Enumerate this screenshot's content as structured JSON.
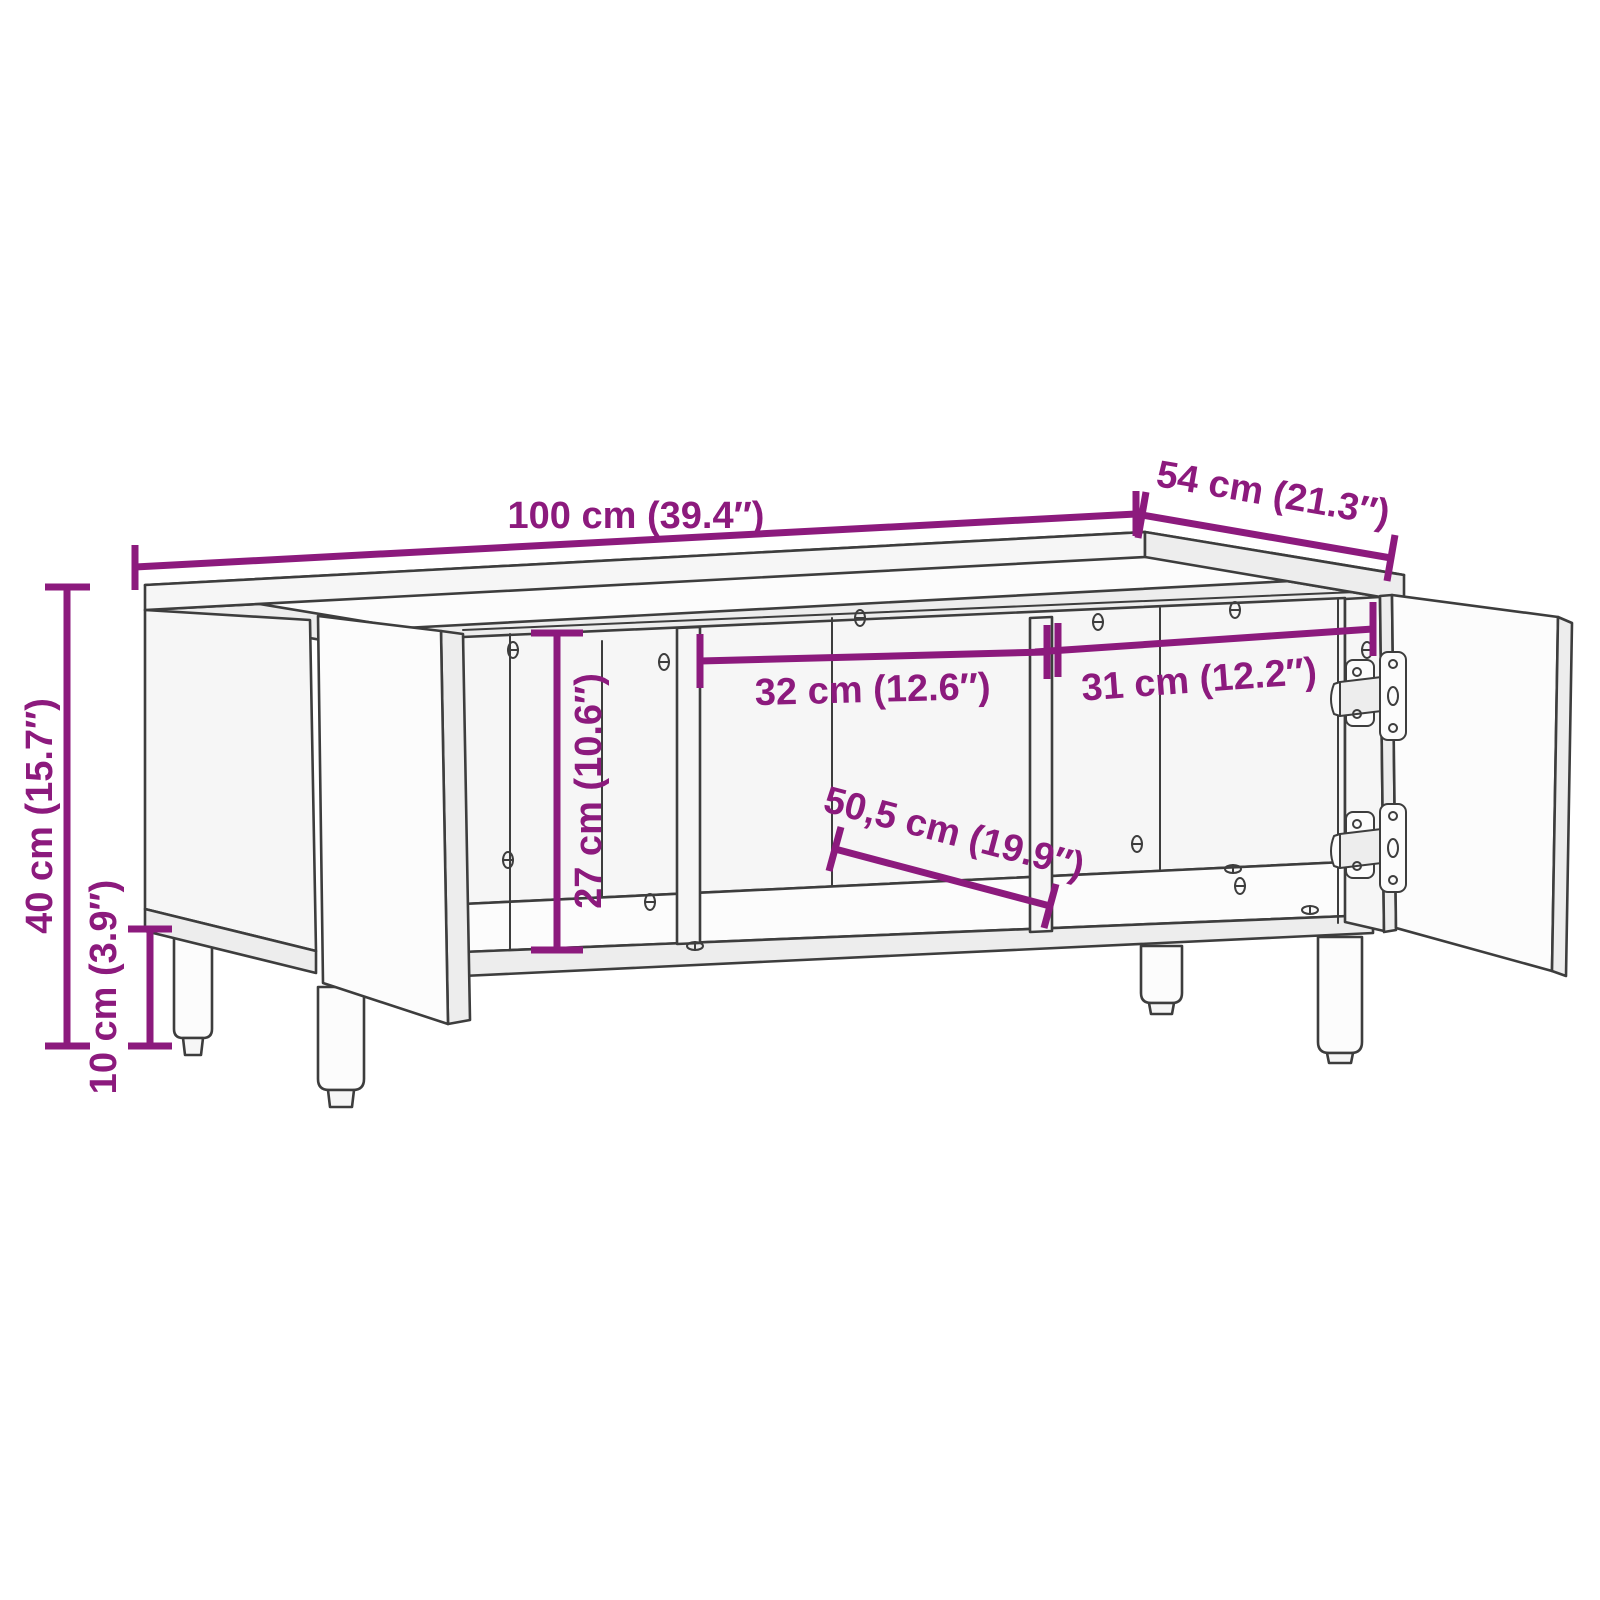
{
  "diagram": {
    "kind": "furniture-dimension-diagram",
    "subject": "cabinet with two open doors, three open compartments and four round legs",
    "colors": {
      "accent": "#8C1A7D",
      "line_art": "#3D3D3D",
      "background": "#FFFFFF"
    },
    "dimensions": {
      "width": {
        "cm": 100,
        "inches": 39.4,
        "label": "100 cm (39.4″)"
      },
      "depth": {
        "cm": 54,
        "inches": 21.3,
        "label": "54 cm (21.3″)"
      },
      "height": {
        "cm": 40,
        "inches": 15.7,
        "label": "40 cm (15.7″)"
      },
      "leg_height": {
        "cm": 10,
        "inches": 3.9,
        "label": "10 cm (3.9″)"
      },
      "inner_height": {
        "cm": 27,
        "inches": 10.6,
        "label": "27 cm (10.6″)"
      },
      "middle_compartment_width": {
        "cm": 32,
        "inches": 12.6,
        "label": "32 cm (12.6″)"
      },
      "right_compartment_width": {
        "cm": 31,
        "inches": 12.2,
        "label": "31 cm (12.2″)"
      },
      "inner_depth": {
        "cm": 50.5,
        "inches": 19.9,
        "label": "50,5 cm (19.9″)"
      }
    }
  }
}
